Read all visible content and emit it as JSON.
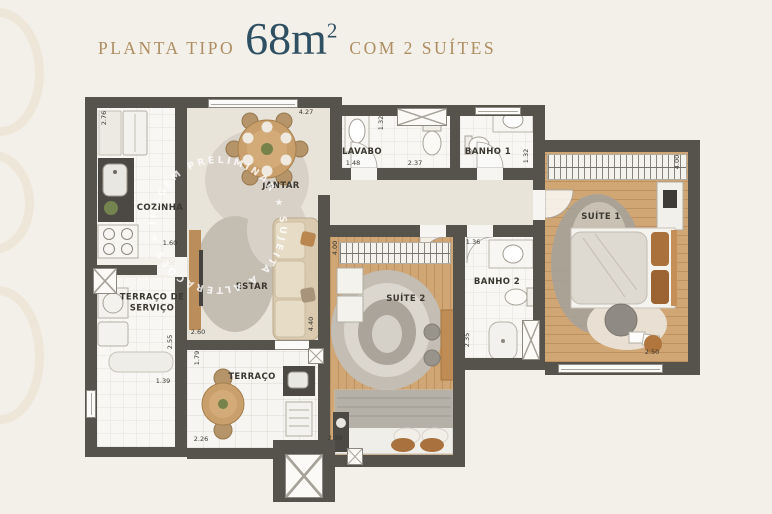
{
  "title": {
    "prefix": "PLANTA TIPO",
    "area": "68m",
    "area_exponent": "2",
    "suffix": "COM 2 SUÍTES"
  },
  "watermark": {
    "text": "IMAGEM PRELIMINAR ★ SUJEITA A ALTERAÇÕES ★"
  },
  "rooms": [
    {
      "id": "cozinha",
      "label": "COZINHA"
    },
    {
      "id": "terraco-servico",
      "label": "TERRAÇO DE SERVIÇO"
    },
    {
      "id": "jantar",
      "label": "JANTAR"
    },
    {
      "id": "estar",
      "label": "ESTAR"
    },
    {
      "id": "lavabo",
      "label": "LAVABO"
    },
    {
      "id": "banho-1",
      "label": "BANHO 1"
    },
    {
      "id": "suite-1",
      "label": "SUÍTE 1"
    },
    {
      "id": "suite-2",
      "label": "SUÍTE 2"
    },
    {
      "id": "banho-2",
      "label": "BANHO 2"
    },
    {
      "id": "terraco",
      "label": "TERRAÇO"
    }
  ],
  "dimensions": [
    {
      "value": "2.76",
      "orientation": "vertical"
    },
    {
      "value": "1.60",
      "orientation": "horizontal"
    },
    {
      "value": "4.27",
      "orientation": "horizontal"
    },
    {
      "value": "1.32",
      "orientation": "vertical"
    },
    {
      "value": "1.48",
      "orientation": "horizontal"
    },
    {
      "value": "2.37",
      "orientation": "horizontal"
    },
    {
      "value": "1.32",
      "orientation": "vertical"
    },
    {
      "value": "4.00",
      "orientation": "vertical"
    },
    {
      "value": "2.50",
      "orientation": "horizontal"
    },
    {
      "value": "1.36",
      "orientation": "horizontal"
    },
    {
      "value": "2.35",
      "orientation": "vertical"
    },
    {
      "value": "4.00",
      "orientation": "vertical"
    },
    {
      "value": "4.40",
      "orientation": "vertical"
    },
    {
      "value": "2.60",
      "orientation": "horizontal"
    },
    {
      "value": "2.55",
      "orientation": "vertical"
    },
    {
      "value": "1.79",
      "orientation": "vertical"
    },
    {
      "value": "1.39",
      "orientation": "horizontal"
    },
    {
      "value": "2.26",
      "orientation": "horizontal"
    },
    {
      "value": "2.38",
      "orientation": "horizontal"
    }
  ],
  "colors": {
    "background": "#f3f0e9",
    "wall": "#56524c",
    "title_accent": "#ad8e62",
    "title_area": "#2f5062",
    "wood_floor": "#d0a674",
    "social_floor": "#e9e4da",
    "wet_floor": "#f8f7f4"
  }
}
